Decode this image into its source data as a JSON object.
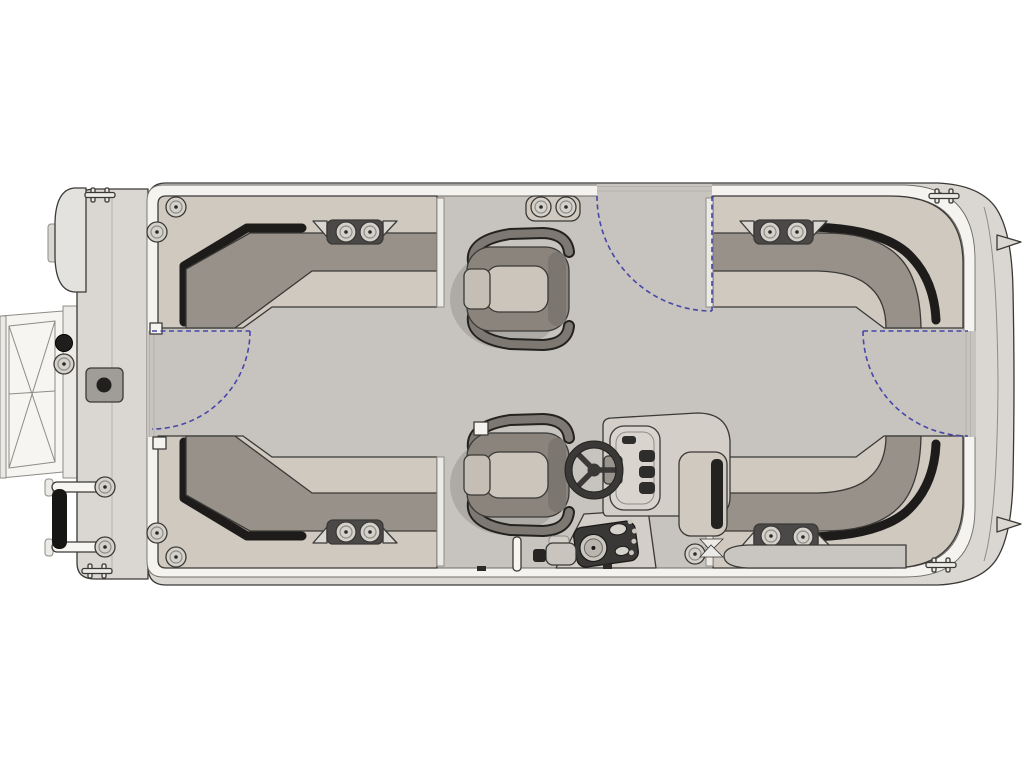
{
  "diagram": {
    "label": "Pontoon boat deck floor plan, top-down view",
    "type": "floorplan",
    "orientation": {
      "bow": "right",
      "stern": "left"
    },
    "colors": {
      "hull": "#dad7d2",
      "fence": "#f4f3f0",
      "deck": "#c7c3be",
      "platform": "#cfc9bf",
      "backrest": "#97918a",
      "gap": "#1d1c1a",
      "outline": "#3a3936",
      "thin": "#8f8c86",
      "chairdark": "#8a847d",
      "chairseat": "#cbc5bc",
      "console": "#d3cec7",
      "consoledark": "#2e2d2b",
      "pod": "#4b4947",
      "dashpod": "#3a3836",
      "washer": "#d4d1cb",
      "metal": "#eceae6",
      "gate": "#4747a8"
    },
    "furniture": {
      "lounges": [
        {
          "name": "stern-port-l-lounge",
          "position": "top-left",
          "speakers": 2
        },
        {
          "name": "bow-port-l-lounge",
          "position": "top-right",
          "speakers": 2
        },
        {
          "name": "stern-starboard-l-lounge",
          "position": "bottom-left",
          "speakers": 2
        },
        {
          "name": "bow-starboard-l-lounge",
          "position": "bottom-right",
          "speakers": 2
        }
      ],
      "chairs": [
        {
          "name": "forward-pedestal-chair",
          "position": "upper-center",
          "facing": "left"
        },
        {
          "name": "aft-pedestal-chair",
          "position": "lower-center",
          "facing": "left"
        }
      ]
    },
    "helm": {
      "position": "lower-right-of-center",
      "components": [
        "steering-wheel",
        "console-windshield",
        "instrument-pod",
        "throttle",
        "armrest-base",
        "cup-holder"
      ]
    },
    "gates": [
      {
        "name": "port-side-gate",
        "location": "left-side",
        "swing": "inward-quarter-arc"
      },
      {
        "name": "side-gate",
        "location": "top-center",
        "swing": "inward-quarter-arc"
      },
      {
        "name": "bow-gate",
        "location": "right-side",
        "swing": "inward-quarter-arc"
      }
    ],
    "exterior": {
      "items": [
        "stern-platform",
        "motor-pod",
        "boarding-ramp",
        "boarding-ladder",
        "bow-fins",
        "mooring-cleat-pod"
      ],
      "cleat_count": 4
    }
  }
}
